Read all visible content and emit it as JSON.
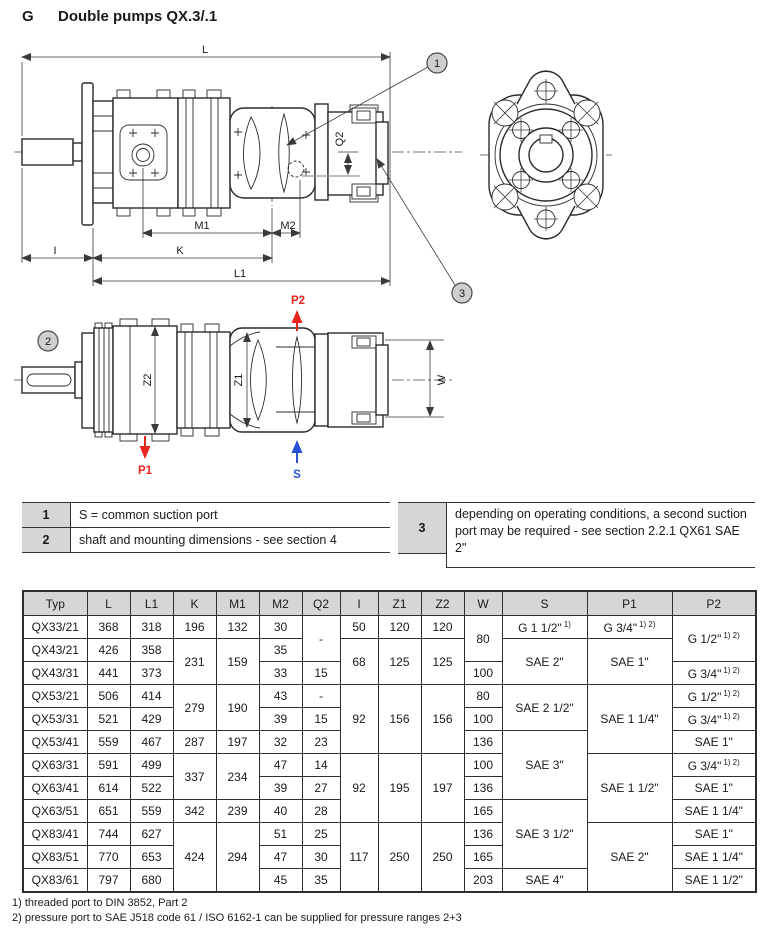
{
  "page": {
    "section_letter": "G",
    "title": "Double pumps QX.3/.1"
  },
  "drawing": {
    "labels": {
      "L": "L",
      "L1": "L1",
      "K": "K",
      "M1": "M1",
      "M2": "M2",
      "Q2": "Q2",
      "I": "I",
      "Z1": "Z1",
      "Z2": "Z2",
      "W": "W"
    },
    "ports": {
      "P1": "P1",
      "P2": "P2",
      "S": "S"
    },
    "callouts": {
      "c1": "1",
      "c2": "2",
      "c3": "3"
    },
    "colors": {
      "pressure_port": "#e8261f",
      "suction_port": "#2952d9",
      "line": "#2b2b2b",
      "callout_fill": "#cfcfcf"
    }
  },
  "notes": [
    {
      "num": "1",
      "text": "S = common suction port"
    },
    {
      "num": "2",
      "text": "shaft and mounting dimensions - see section 4"
    },
    {
      "num": "3",
      "text": "depending on operating conditions, a second suction port may be required - see section 2.2.1 QX61 SAE 2\""
    }
  ],
  "table": {
    "headers": [
      "Typ",
      "L",
      "L1",
      "K",
      "M1",
      "M2",
      "Q2",
      "I",
      "Z1",
      "Z2",
      "W",
      "S",
      "P1",
      "P2"
    ],
    "rows": [
      [
        {
          "t": "QX33/21"
        },
        {
          "t": "368"
        },
        {
          "t": "318"
        },
        {
          "t": "196"
        },
        {
          "t": "132"
        },
        {
          "t": "30"
        },
        {
          "t": "-",
          "rs": 2
        },
        {
          "t": "50"
        },
        {
          "t": "120"
        },
        {
          "t": "120"
        },
        {
          "t": "80",
          "rs": 2
        },
        {
          "t": "G 1 1/2\"",
          "sup": "1)"
        },
        {
          "t": "G 3/4\"",
          "sup": "1) 2)"
        },
        {
          "t": "G 1/2\"",
          "sup": "1) 2)",
          "rs": 2
        }
      ],
      [
        {
          "t": "QX43/21"
        },
        {
          "t": "426"
        },
        {
          "t": "358"
        },
        {
          "t": "231",
          "rs": 2
        },
        {
          "t": "159",
          "rs": 2
        },
        {
          "t": "35"
        },
        null,
        {
          "t": "68",
          "rs": 2
        },
        {
          "t": "125",
          "rs": 2
        },
        {
          "t": "125",
          "rs": 2
        },
        null,
        {
          "t": "SAE 2\"",
          "rs": 2
        },
        {
          "t": "SAE 1\"",
          "rs": 2
        },
        null
      ],
      [
        {
          "t": "QX43/31"
        },
        {
          "t": "441"
        },
        {
          "t": "373"
        },
        null,
        null,
        {
          "t": "33"
        },
        {
          "t": "15"
        },
        null,
        null,
        null,
        {
          "t": "100"
        },
        null,
        null,
        {
          "t": "G 3/4\"",
          "sup": "1) 2)"
        }
      ],
      [
        {
          "t": "QX53/21"
        },
        {
          "t": "506"
        },
        {
          "t": "414"
        },
        {
          "t": "279",
          "rs": 2
        },
        {
          "t": "190",
          "rs": 2
        },
        {
          "t": "43"
        },
        {
          "t": "-"
        },
        {
          "t": "92",
          "rs": 3
        },
        {
          "t": "156",
          "rs": 3
        },
        {
          "t": "156",
          "rs": 3
        },
        {
          "t": "80"
        },
        {
          "t": "SAE 2 1/2\"",
          "rs": 2
        },
        {
          "t": "SAE 1 1/4\"",
          "rs": 3
        },
        {
          "t": "G 1/2\"",
          "sup": "1) 2)"
        }
      ],
      [
        {
          "t": "QX53/31"
        },
        {
          "t": "521"
        },
        {
          "t": "429"
        },
        null,
        null,
        {
          "t": "39"
        },
        {
          "t": "15"
        },
        null,
        null,
        null,
        {
          "t": "100"
        },
        null,
        null,
        {
          "t": "G 3/4\"",
          "sup": "1) 2)"
        }
      ],
      [
        {
          "t": "QX53/41"
        },
        {
          "t": "559"
        },
        {
          "t": "467"
        },
        {
          "t": "287"
        },
        {
          "t": "197"
        },
        {
          "t": "32"
        },
        {
          "t": "23"
        },
        null,
        null,
        null,
        {
          "t": "136"
        },
        {
          "t": "SAE 3\"",
          "rs": 3
        },
        null,
        {
          "t": "SAE 1\""
        }
      ],
      [
        {
          "t": "QX63/31"
        },
        {
          "t": "591"
        },
        {
          "t": "499"
        },
        {
          "t": "337",
          "rs": 2
        },
        {
          "t": "234",
          "rs": 2
        },
        {
          "t": "47"
        },
        {
          "t": "14"
        },
        {
          "t": "92",
          "rs": 3
        },
        {
          "t": "195",
          "rs": 3
        },
        {
          "t": "197",
          "rs": 3
        },
        {
          "t": "100"
        },
        null,
        {
          "t": "SAE 1 1/2\"",
          "rs": 3
        },
        {
          "t": "G 3/4\"",
          "sup": "1) 2)"
        }
      ],
      [
        {
          "t": "QX63/41"
        },
        {
          "t": "614"
        },
        {
          "t": "522"
        },
        null,
        null,
        {
          "t": "39"
        },
        {
          "t": "27"
        },
        null,
        null,
        null,
        {
          "t": "136"
        },
        null,
        null,
        {
          "t": "SAE 1\""
        }
      ],
      [
        {
          "t": "QX63/51"
        },
        {
          "t": "651"
        },
        {
          "t": "559"
        },
        {
          "t": "342"
        },
        {
          "t": "239"
        },
        {
          "t": "40"
        },
        {
          "t": "28"
        },
        null,
        null,
        null,
        {
          "t": "165"
        },
        {
          "t": "SAE 3 1/2\"",
          "rs": 3
        },
        null,
        {
          "t": "SAE 1 1/4\""
        }
      ],
      [
        {
          "t": "QX83/41"
        },
        {
          "t": "744"
        },
        {
          "t": "627"
        },
        {
          "t": "424",
          "rs": 3
        },
        {
          "t": "294",
          "rs": 3
        },
        {
          "t": "51"
        },
        {
          "t": "25"
        },
        {
          "t": "117",
          "rs": 3
        },
        {
          "t": "250",
          "rs": 3
        },
        {
          "t": "250",
          "rs": 3
        },
        {
          "t": "136"
        },
        null,
        {
          "t": "SAE 2\"",
          "rs": 3
        },
        {
          "t": "SAE 1\""
        }
      ],
      [
        {
          "t": "QX83/51"
        },
        {
          "t": "770"
        },
        {
          "t": "653"
        },
        null,
        null,
        {
          "t": "47"
        },
        {
          "t": "30"
        },
        null,
        null,
        null,
        {
          "t": "165"
        },
        null,
        null,
        {
          "t": "SAE 1 1/4\""
        }
      ],
      [
        {
          "t": "QX83/61"
        },
        {
          "t": "797"
        },
        {
          "t": "680"
        },
        null,
        null,
        {
          "t": "45"
        },
        {
          "t": "35"
        },
        null,
        null,
        null,
        {
          "t": "203"
        },
        {
          "t": "SAE 4\""
        },
        null,
        {
          "t": "SAE 1 1/2\""
        }
      ]
    ]
  },
  "footnotes": [
    "1) threaded port to DIN 3852, Part 2",
    "2) pressure port to SAE J518 code 61 / ISO 6162-1 can be supplied for pressure ranges 2+3"
  ]
}
